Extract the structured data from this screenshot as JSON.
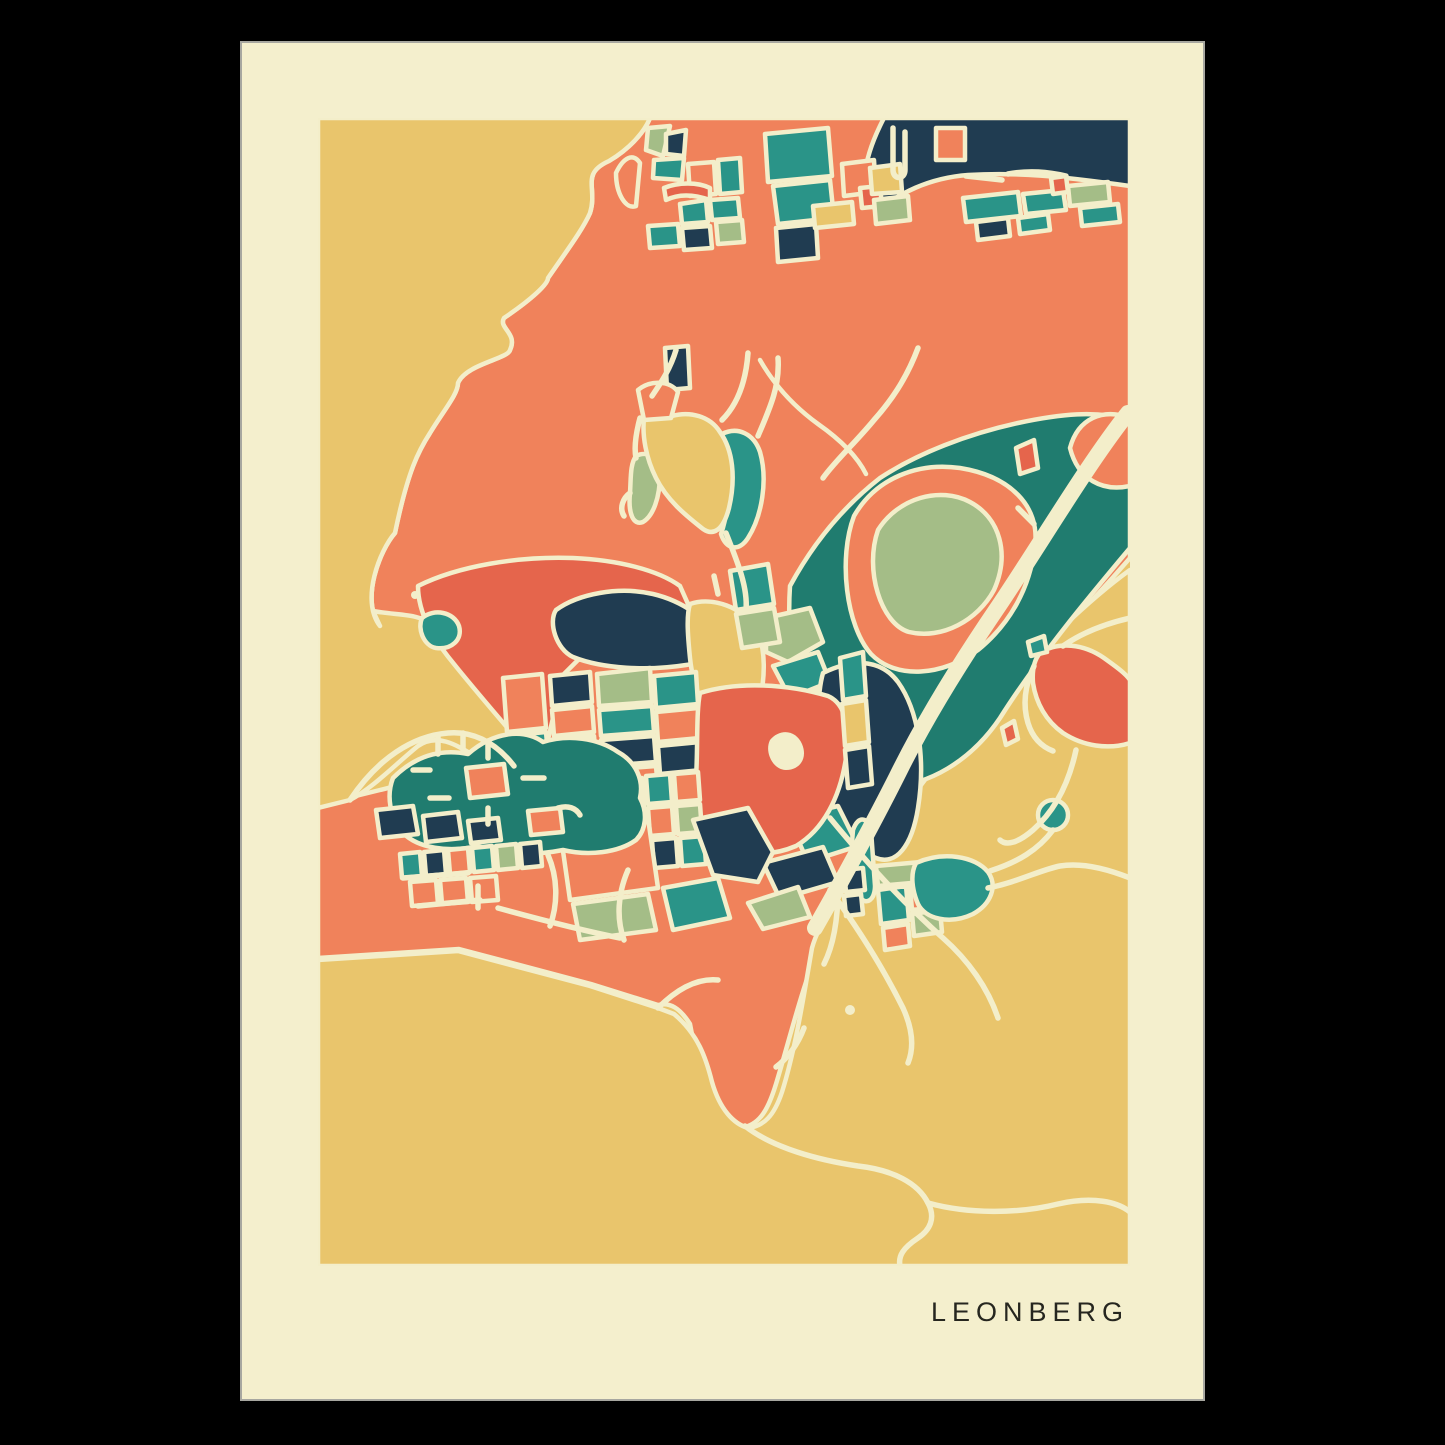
{
  "poster": {
    "title": "LEONBERG"
  },
  "palette": {
    "black": "#000000",
    "cream": "#f4efcd",
    "road": "#f3eeca",
    "yellow": "#e9c56c",
    "orange": "#f0825b",
    "red": "#e5654c",
    "navy": "#203c51",
    "teal": "#2a9488",
    "tealdeep": "#207c6f",
    "sage": "#a4bd87",
    "ink": "#26261f"
  }
}
